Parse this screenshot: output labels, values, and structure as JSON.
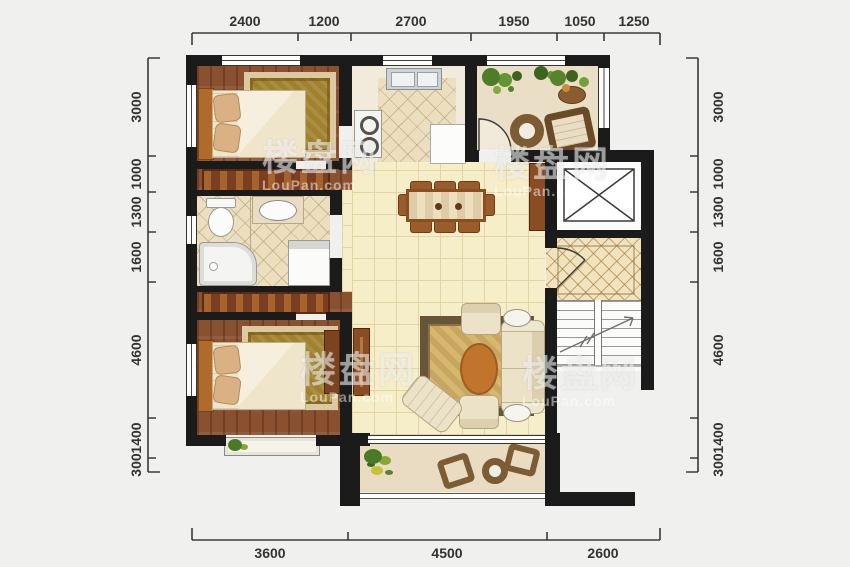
{
  "watermark": {
    "cn": "楼盘网",
    "en": "LouPan.com"
  },
  "rulers": {
    "top": {
      "values": [
        "2400",
        "1200",
        "2700",
        "1950",
        "1050",
        "1250"
      ]
    },
    "bottom": {
      "values": [
        "3600",
        "4500",
        "2600"
      ]
    },
    "left": {
      "values": [
        "3000",
        "1000",
        "1300",
        "1600",
        "4600",
        "1400",
        "300"
      ]
    },
    "right": {
      "values": [
        "3000",
        "1000",
        "1300",
        "1600",
        "4600",
        "1400",
        "300"
      ]
    }
  },
  "colors": {
    "wall": "#1b1b1b",
    "wood_floor": "#8a5130",
    "tile_cream": "#f6edc9",
    "tile_bath": "#ecdfc0",
    "bedroom_rug": "#a0812e",
    "living_rug": "#d7b76e",
    "plant": "#4e7c28"
  }
}
